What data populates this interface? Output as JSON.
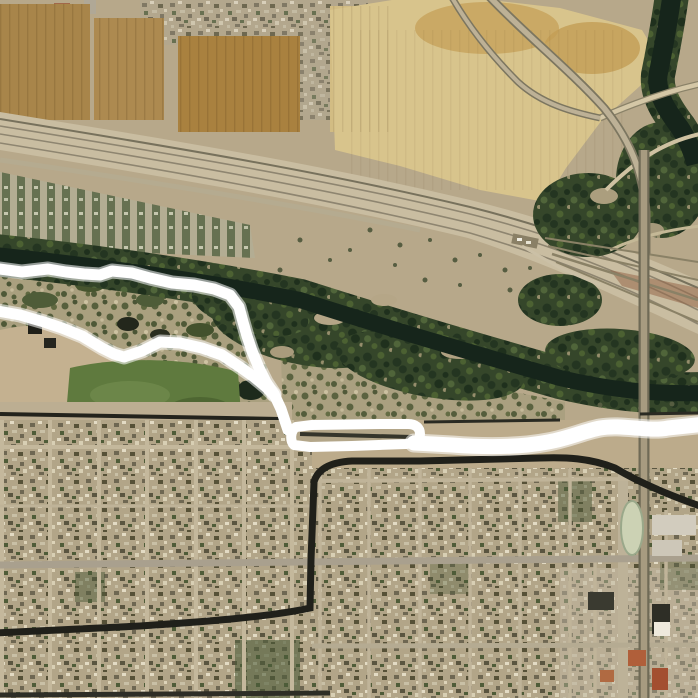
{
  "meta": {
    "kind": "aerial-satellite-map-screenshot",
    "width_px": 698,
    "height_px": 698,
    "visible_text": "none"
  },
  "palette": {
    "desert": "#b7a88a",
    "field-brown": "#a9813f",
    "field-mid": "#ad8a50",
    "field-pale": "#d8c48c",
    "field-gold": "#c8a55e",
    "water": "#16251b",
    "riparian": "#35462a",
    "scrub": "#a89f7e",
    "urban": "#b2a588",
    "road": "#c9bda1",
    "canal": "#20201a",
    "park-green": "#5f7a3e",
    "overlay-line": "#ffffff"
  },
  "features": [
    {
      "name": "agricultural-fields",
      "area": "top"
    },
    {
      "name": "settlement-strip",
      "area": "top-edge"
    },
    {
      "name": "rail-road-corridor",
      "area": "upper diagonal"
    },
    {
      "name": "trailer-park-rows",
      "area": "upper-left"
    },
    {
      "name": "river-channel",
      "area": "middle, dark winding band"
    },
    {
      "name": "river-hook",
      "area": "top-right"
    },
    {
      "name": "riparian-vegetation",
      "area": "middle"
    },
    {
      "name": "highway-curve-and-interchange",
      "area": "top-right"
    },
    {
      "name": "vertical-highway",
      "area": "right"
    },
    {
      "name": "rail-fan-yard",
      "area": "mid-right"
    },
    {
      "name": "city-park",
      "area": "mid-left"
    },
    {
      "name": "urban-street-grid",
      "area": "bottom half"
    },
    {
      "name": "canal",
      "area": "dark L-shaped channel through city"
    },
    {
      "name": "white-annotation-lines",
      "area": "hand-drawn white overlay"
    }
  ],
  "annotations": {
    "overlay_color": "#ffffff",
    "line_a": "M-8,268 L22,272 48,269 66,272 84,274 100,275 112,271 132,273 150,278 172,283 194,285 214,289 230,295 239,307 243,322 247,336 252,351 259,368 266,382 274,394",
    "line_b": "M-8,310 L20,315 44,322 62,328 82,336 102,348 114,354 124,357 142,351 160,342 180,343 202,348 222,355 240,367 254,377 266,387 274,395",
    "connector": "M274,394 L281,409 285,421 288,430",
    "enclosure_loop": "M294,445 C290,441 290,431 296,427 L312,425 L380,424 L408,424 C416,424 420,428 420,434 C420,440 414,443 406,444 L352,446 L310,447 Z",
    "east_band": "M414,443 L452,445 C492,448 522,447 548,442 C570,438 584,431 600,428 C622,424 648,432 668,428 L706,424"
  }
}
